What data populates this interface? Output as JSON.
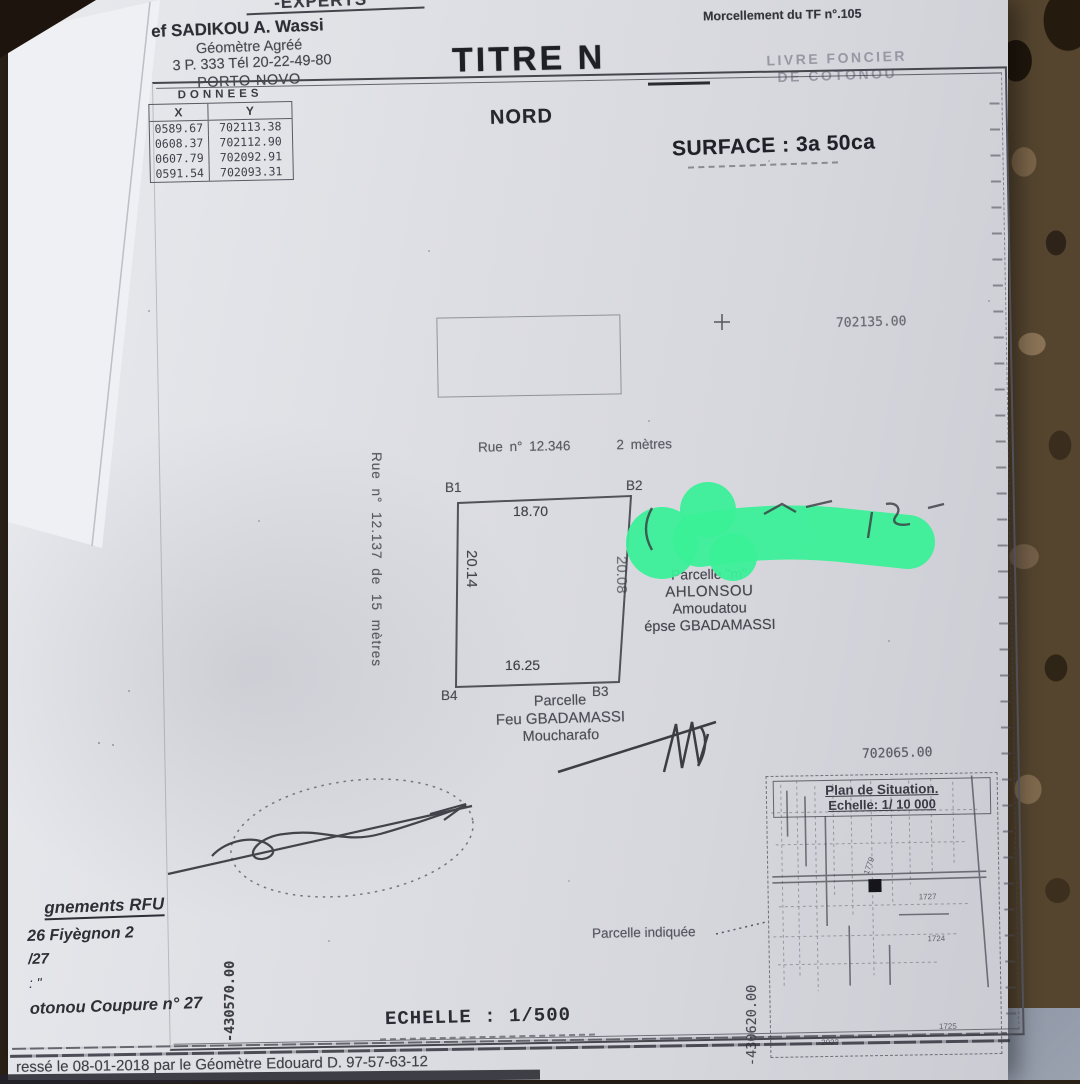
{
  "letterhead": {
    "cut_line": "-EXPERTS",
    "name": "ef SADIKOU A. Wassi",
    "role": "Géomètre Agréé",
    "address": "3 P. 333 Tél 20-22-49-80",
    "city": "PORTO-NOVO"
  },
  "title_block": {
    "title": "TITRE N"
  },
  "top_right": {
    "morcellement": "Morcellement du TF n°.105",
    "livre_line1": "LIVRE FONCIER",
    "livre_line2": "DE COTONOU"
  },
  "plan": {
    "north": "NORD",
    "surface": "SURFACE : 3a 50ca",
    "grid": {
      "y_top": "702135.00",
      "y_mid": "702065.00",
      "x_left": "-430570.00",
      "x_right": "-430620.00"
    },
    "street_top": {
      "name": "Rue n° 12.346",
      "width": "2 mètres"
    },
    "street_left": "Rue n° 12.137 de 15 mètres",
    "parcel": {
      "corner_tl": "B1",
      "corner_tr": "B2",
      "corner_br": "B3",
      "corner_bl": "B4",
      "dim_top": "18.70",
      "dim_left": "20.14",
      "dim_right": "20.08",
      "dim_bottom": "16.25"
    },
    "owner": {
      "line1": "Parcelle \"m\"",
      "line2": "AHLONSOU",
      "line3": "Amoudatou",
      "line4": "épse GBADAMASSI"
    },
    "south_parcel": {
      "line1": "Parcelle",
      "line2": "Feu GBADAMASSI",
      "line3": "Moucharafo"
    },
    "scale": "ECHELLE : 1/500"
  },
  "coords_table": {
    "title": "DONNEES",
    "col_x": "X",
    "col_y": "Y",
    "rows": [
      [
        "0589.67",
        "702113.38"
      ],
      [
        "0608.37",
        "702112.90"
      ],
      [
        "0607.79",
        "702092.91"
      ],
      [
        "0591.54",
        "702093.31"
      ]
    ]
  },
  "situation": {
    "title": "Plan de Situation.",
    "scale": "Echelle: 1/ 10 000",
    "indicated": "Parcelle indiquée",
    "numbers": [
      "1779",
      "1727",
      "1724",
      "1725",
      "2023"
    ]
  },
  "bottom_left": {
    "line1": "gnements RFU",
    "line2": "26 Fiyègnon 2",
    "line3": "/27",
    "line4": ": \"",
    "line5": "otonou Coupure n° 27"
  },
  "footer": "ressé le 08-01-2018 par le Géomètre Edouard D. 97-57-63-12",
  "colors": {
    "highlight_green": "#3bf098",
    "paper": "#e2e3e8",
    "carpet_brown": "#55452f",
    "corner_grey": "#939cab"
  }
}
